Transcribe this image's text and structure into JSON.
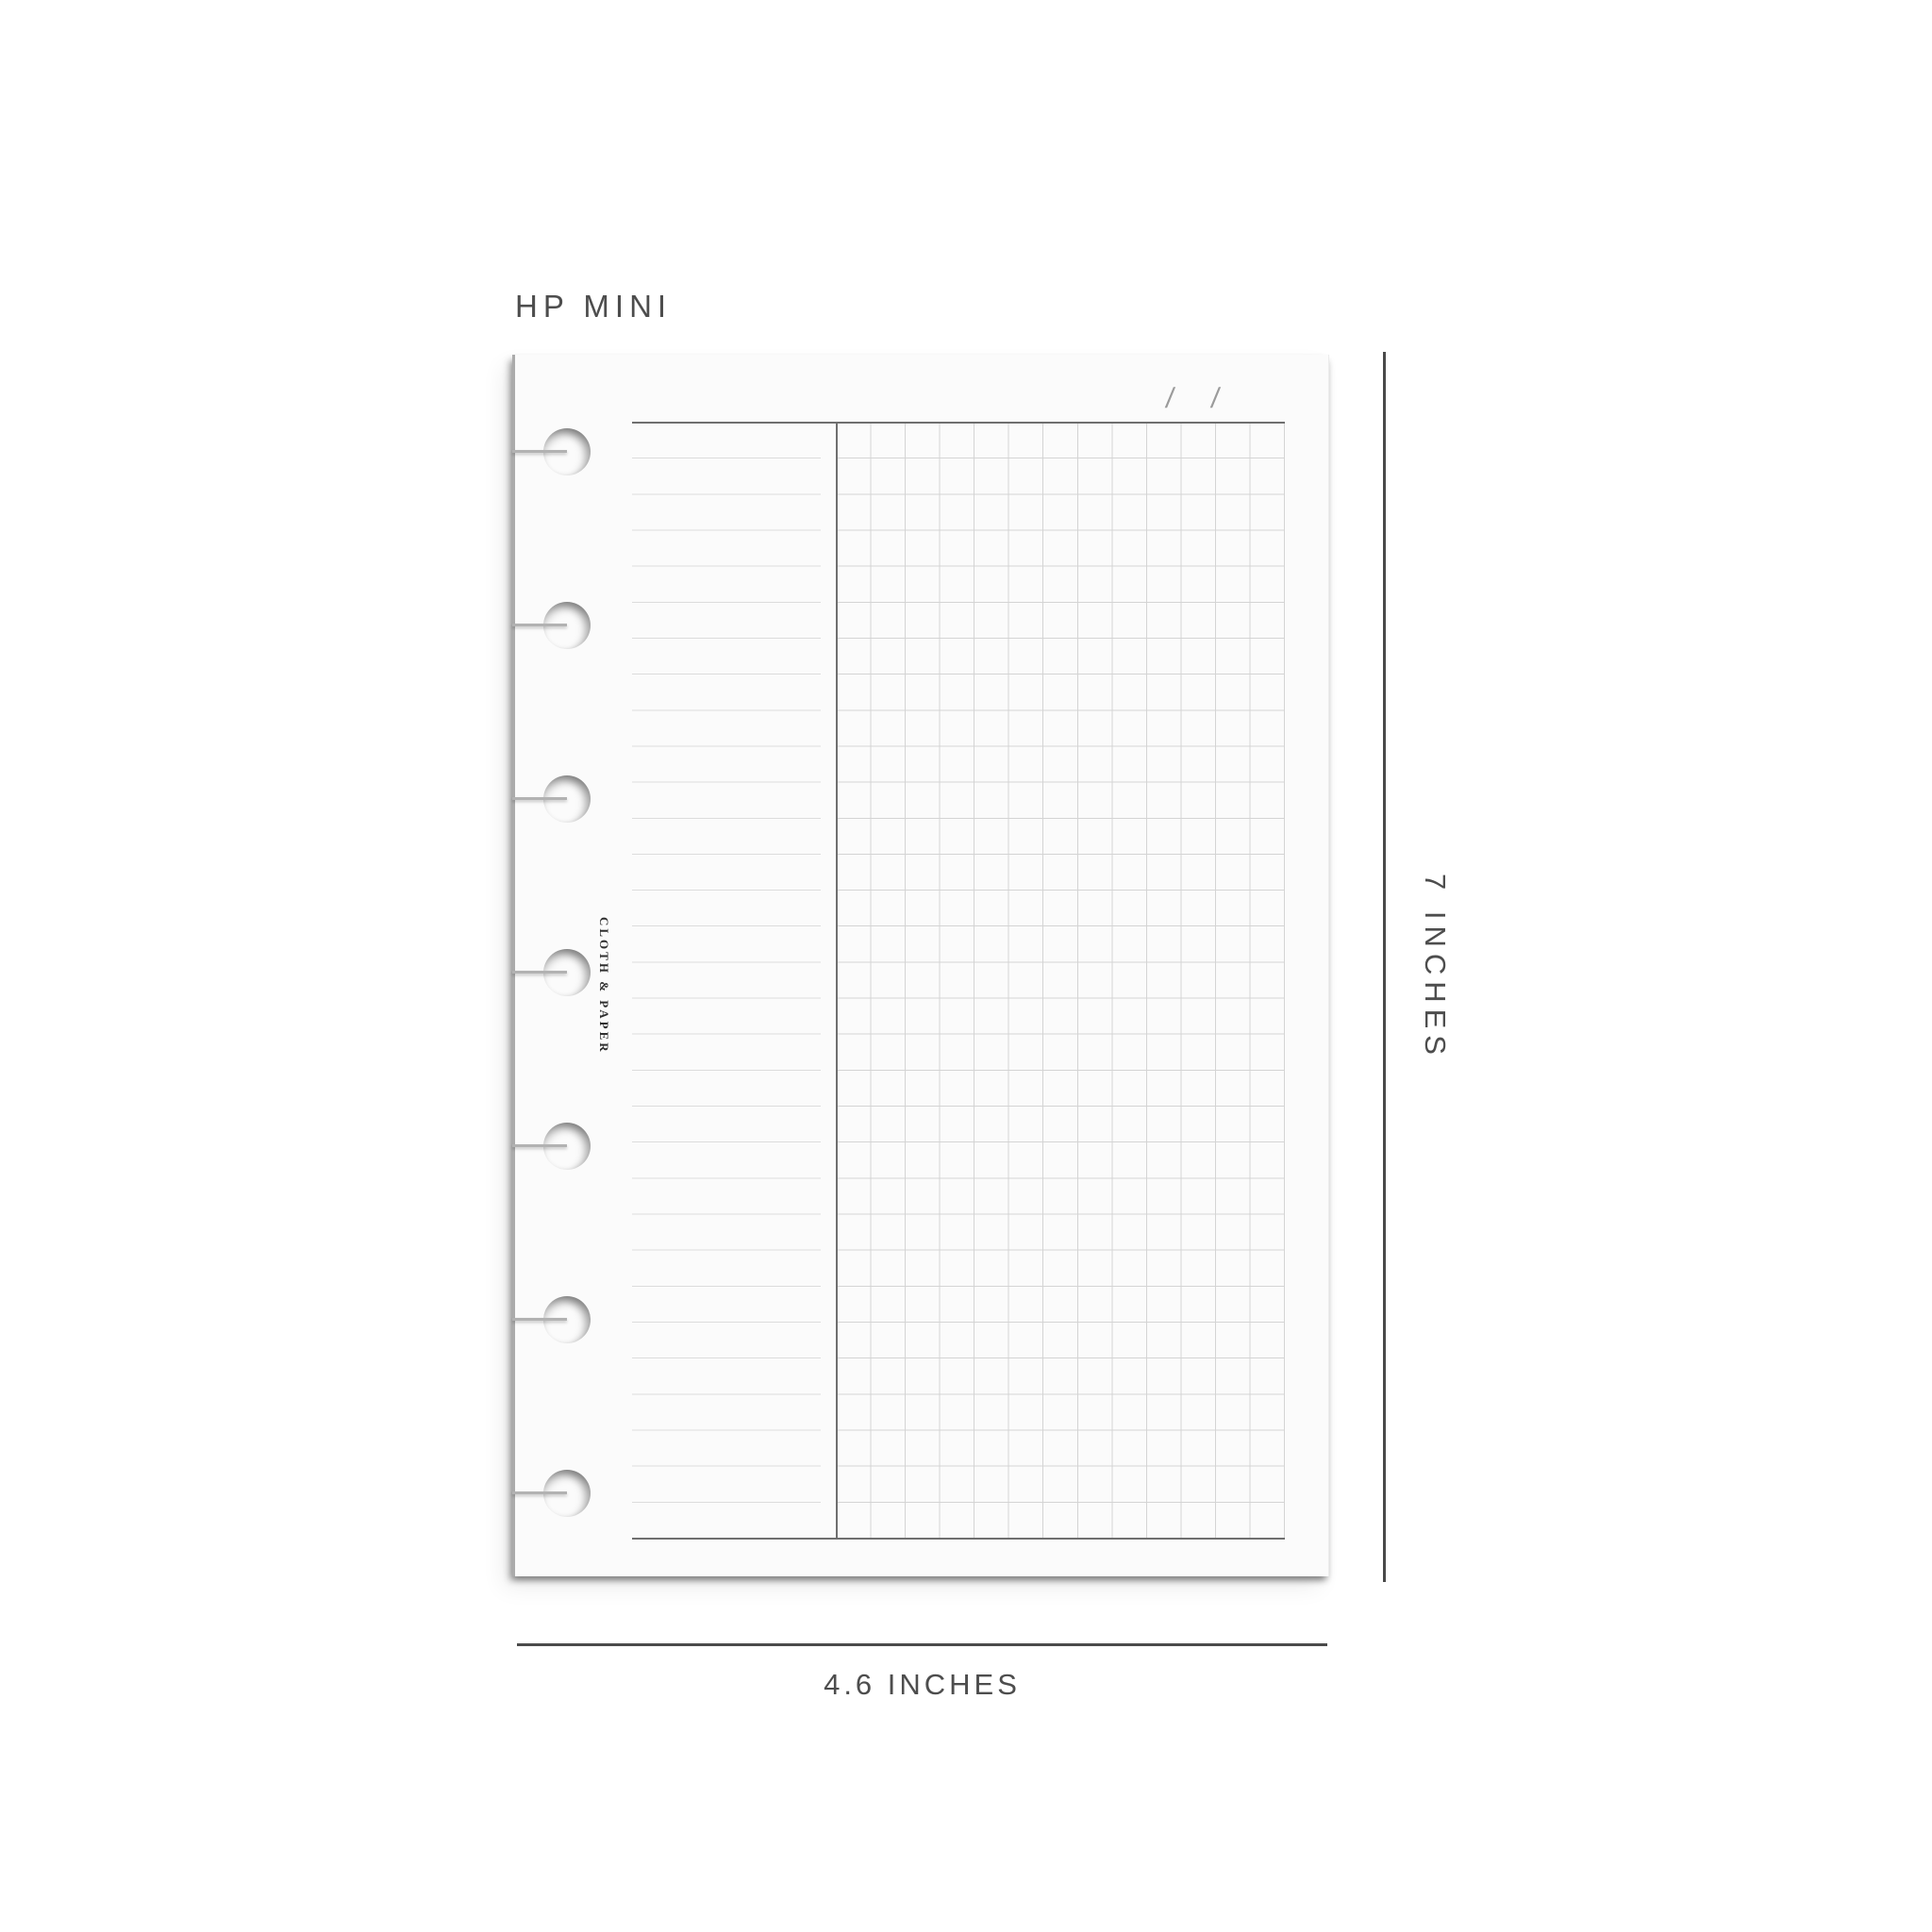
{
  "size_label": "HP MINI",
  "page": {
    "brand_text": "CLOTH & PAPER",
    "date_slashes": [
      "/",
      "/"
    ],
    "punch_count": 7,
    "left_column": "ruled-lines",
    "right_column": "grid"
  },
  "dimensions": {
    "height_label": "7 INCHES",
    "width_label": "4.6 INCHES"
  },
  "colors": {
    "background": "#ffffff",
    "paper": "#fbfbfb",
    "annotation_text": "#4d4d4d",
    "dimension_line": "#4a4a4a",
    "rule_dark": "#6f6f6f",
    "rule_light": "#dcdcdc",
    "grid_line": "#d4d4d4",
    "brand_text": "#2f2f2f",
    "date_slash": "#9b9b9b"
  }
}
